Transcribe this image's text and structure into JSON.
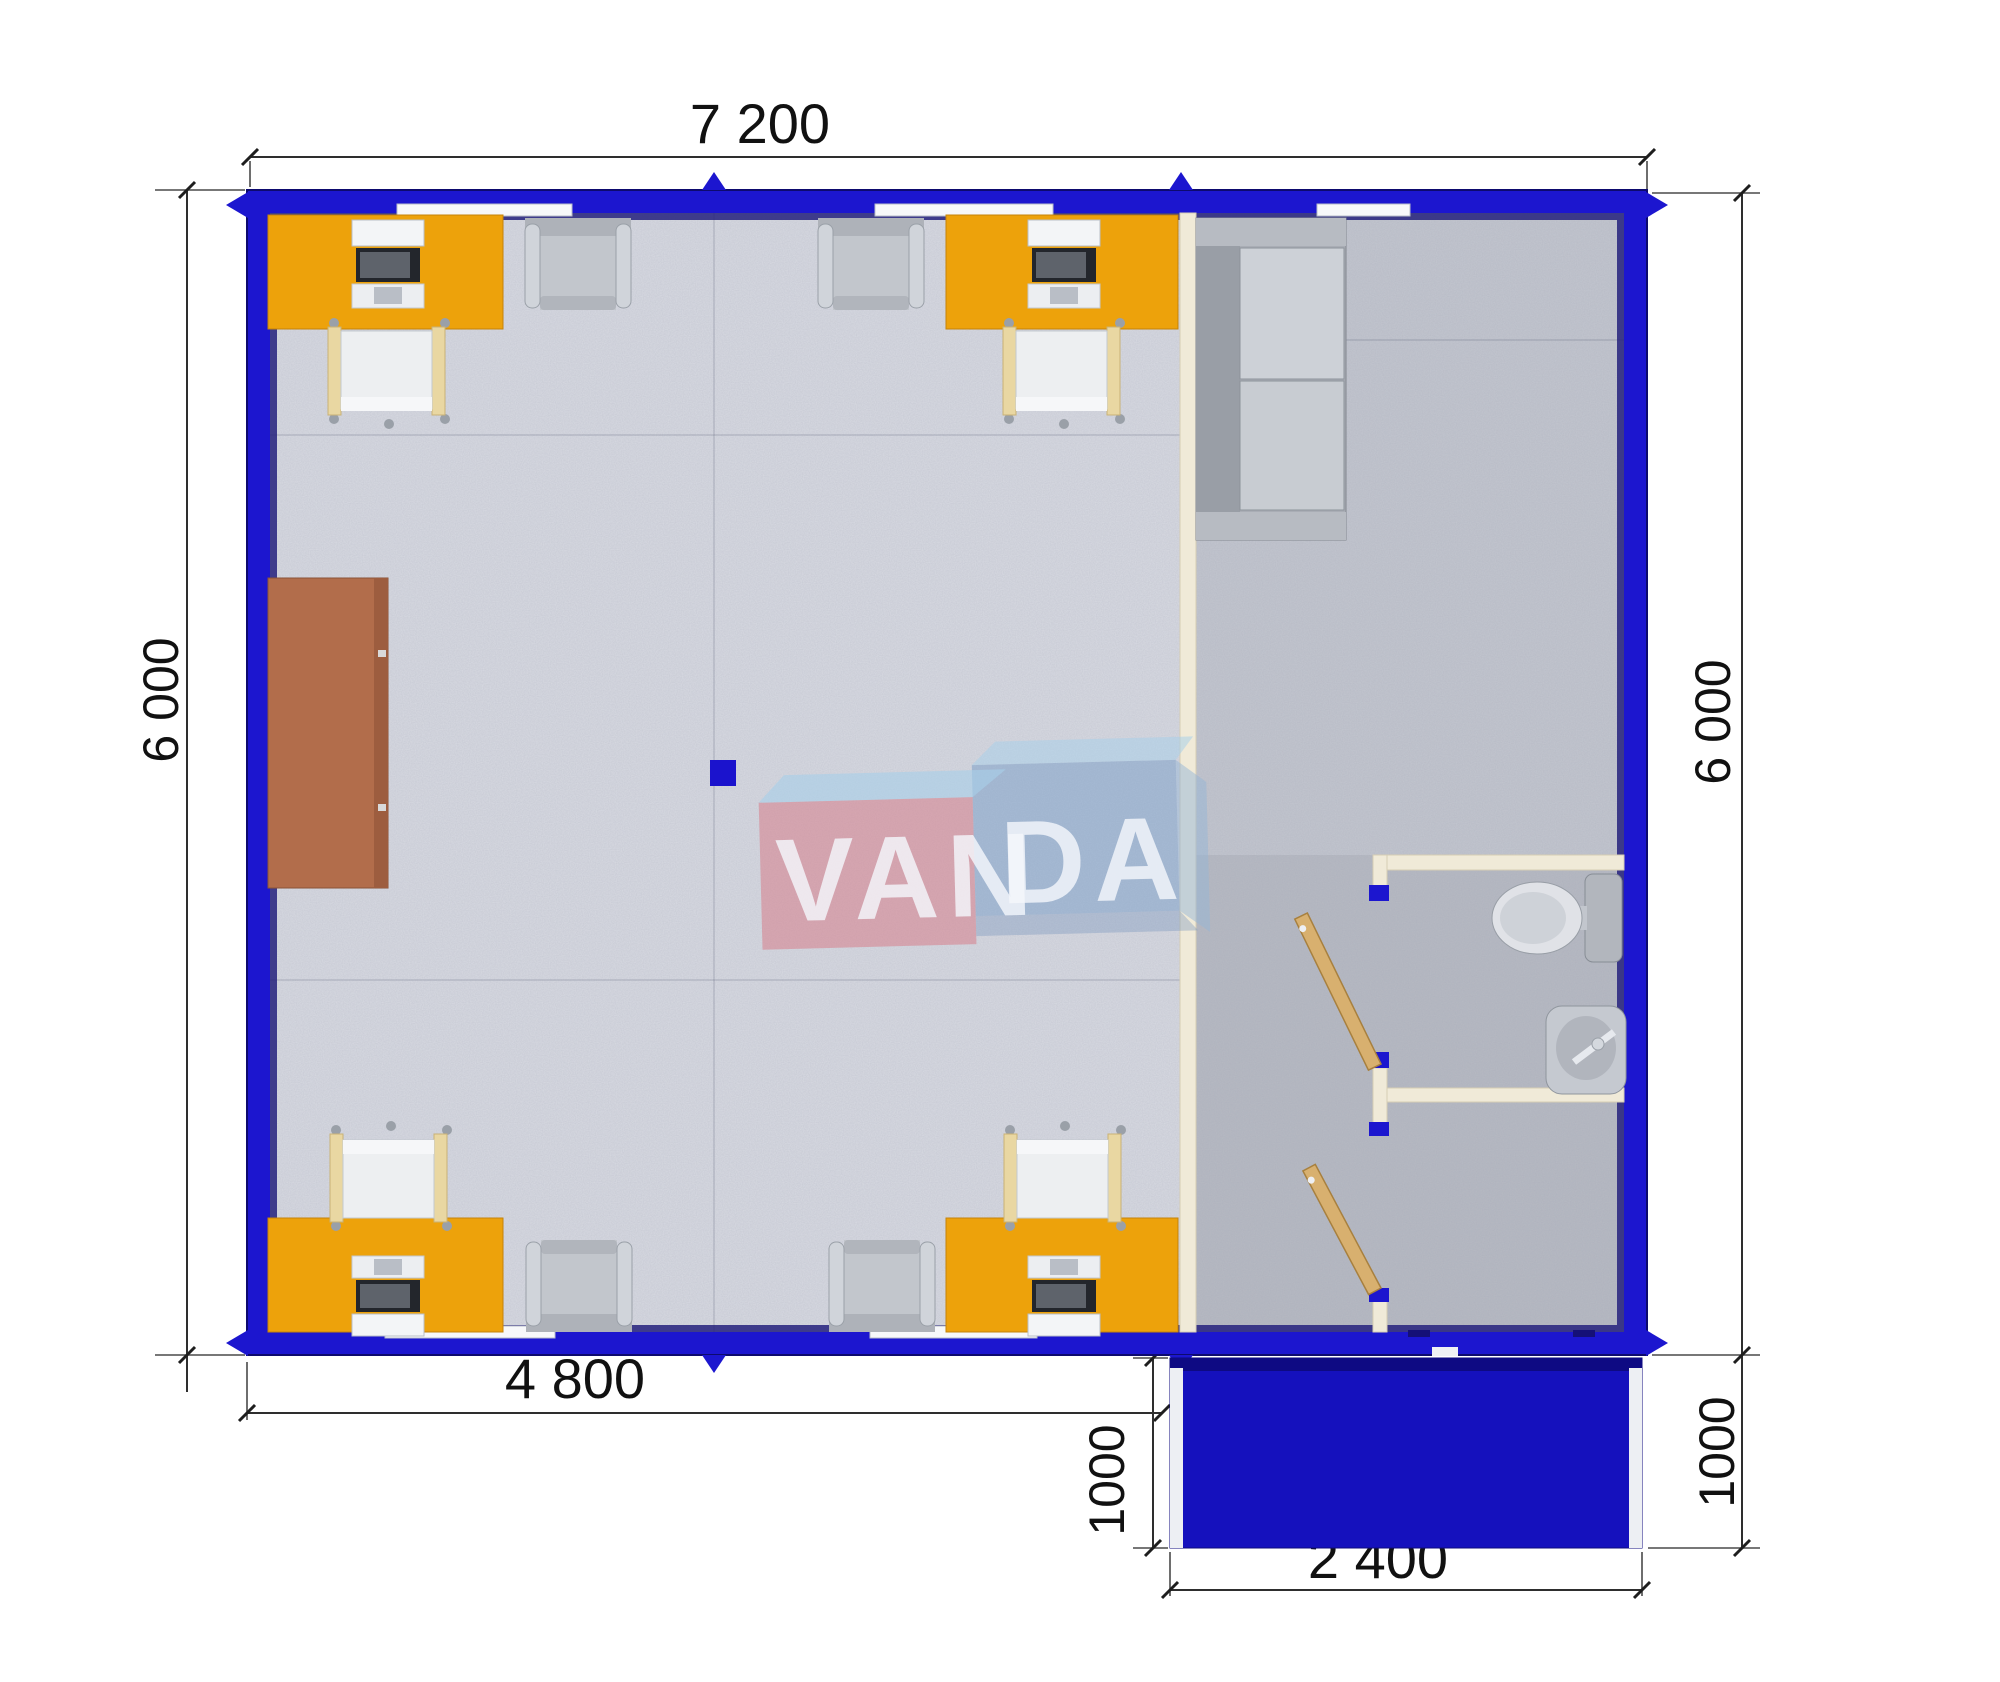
{
  "plan": {
    "type": "modular-building-floor-plan",
    "building": {
      "width_label": "7 200",
      "height_label_left": "6 000",
      "height_label_right": "6 000",
      "office_width_label": "4 800"
    },
    "porch": {
      "depth_label_left": "1000",
      "width_label": "2 400",
      "depth_label_right": "1000"
    },
    "watermark": {
      "left": "VAN",
      "right": "DA",
      "pink": "#d77d8a",
      "blue": "#7da0c8"
    },
    "colors": {
      "wall_blue": "#1c16cf",
      "porch_blue": "#1511bd",
      "desk_orange": "#eda20b",
      "cabinet_brown": "#b26d4b",
      "office_floor": "#d8dae2",
      "annex_floor": "#c3c6cf",
      "wet_zone_floor": "#b7bac3",
      "partition_cream": "#f0ead8",
      "door_wood": "#d8b06f"
    },
    "furniture": [
      {
        "name": "workstation-desk",
        "count": 4
      },
      {
        "name": "office-chair",
        "count": 4
      },
      {
        "name": "visitor-chair",
        "count": 4
      },
      {
        "name": "sofa",
        "count": 1
      },
      {
        "name": "storage-cabinet",
        "count": 1
      },
      {
        "name": "toilet",
        "count": 1
      },
      {
        "name": "wash-basin",
        "count": 1
      },
      {
        "name": "interior-door",
        "count": 2
      }
    ]
  }
}
